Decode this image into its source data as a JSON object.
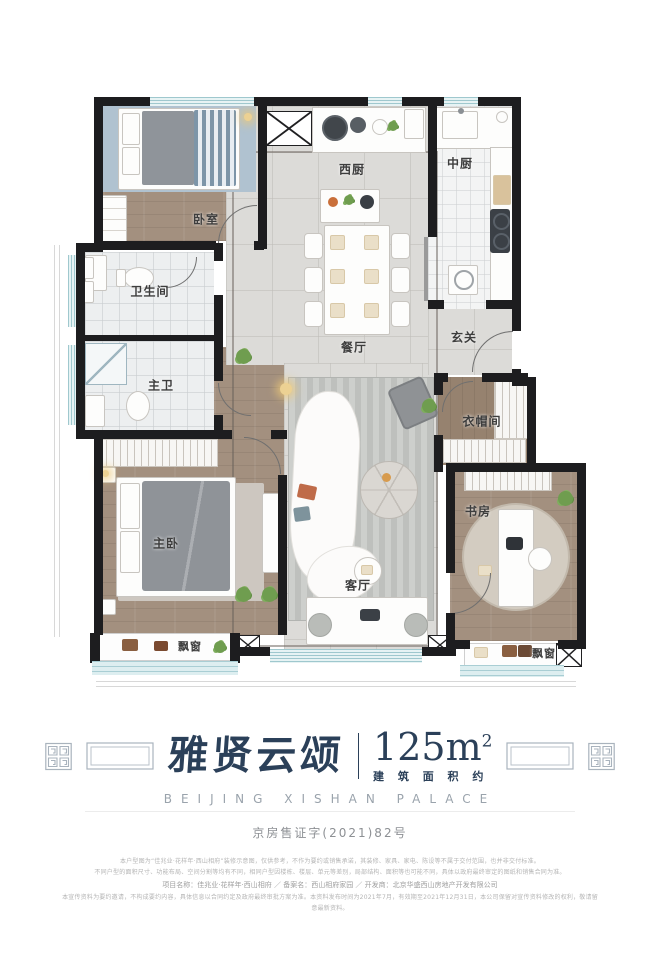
{
  "plan": {
    "rooms": {
      "bedroom": "卧室",
      "bathroom": "卫生间",
      "master_bath": "主卫",
      "master_bedroom": "主卧",
      "west_kitchen": "西厨",
      "dining": "餐厅",
      "middle_kitchen": "中厨",
      "entry": "玄关",
      "cloakroom": "衣帽间",
      "study": "书房",
      "living": "客厅",
      "bay_window_left": "飘窗",
      "bay_window_right": "飘窗"
    }
  },
  "title": {
    "name": "雅贤云颂",
    "area_value": "125m",
    "area_sup": "2",
    "area_caption": "建 筑 面 积 约",
    "en": "BEIJING XISHAN PALACE"
  },
  "license": "京房售证字(2021)82号",
  "disclaimer": {
    "line1": "本户型图为“佳兆业·花样年·西山相府”装修示意图，仅供参考，不作为要约或销售承诺，其装修、家具、家电、陈设等不属于交付范围，也并非交付标准。",
    "line2": "不同户型的面积尺寸、功能布局、空间分割等均有不同，相同户型因楼栋、楼层、单元等差别，局部结构、面积等也可能不同，具体以政府最终审定的图纸和销售合同为准。",
    "line3": "项目名称：佳兆业·花样年·西山相府 ／ 备案名：西山相府家园 ／ 开发商：北京华盛西山房地产开发有限公司",
    "line4": "本宣传资料为要约邀请，不构成要约内容，具体信息以合同约定及政府最终审批方案为准。本资料发布时间为2021年7月，有效期至2021年12月31日，本公司保留对宣传资料修改的权利，敬请留意最新资料。"
  },
  "colors": {
    "brand_navy": "#2b4059",
    "wall_black": "#1d1d1f",
    "window_blue": "#bfdde2",
    "wood": "#a3907f",
    "marble": "#dcdbd8"
  }
}
